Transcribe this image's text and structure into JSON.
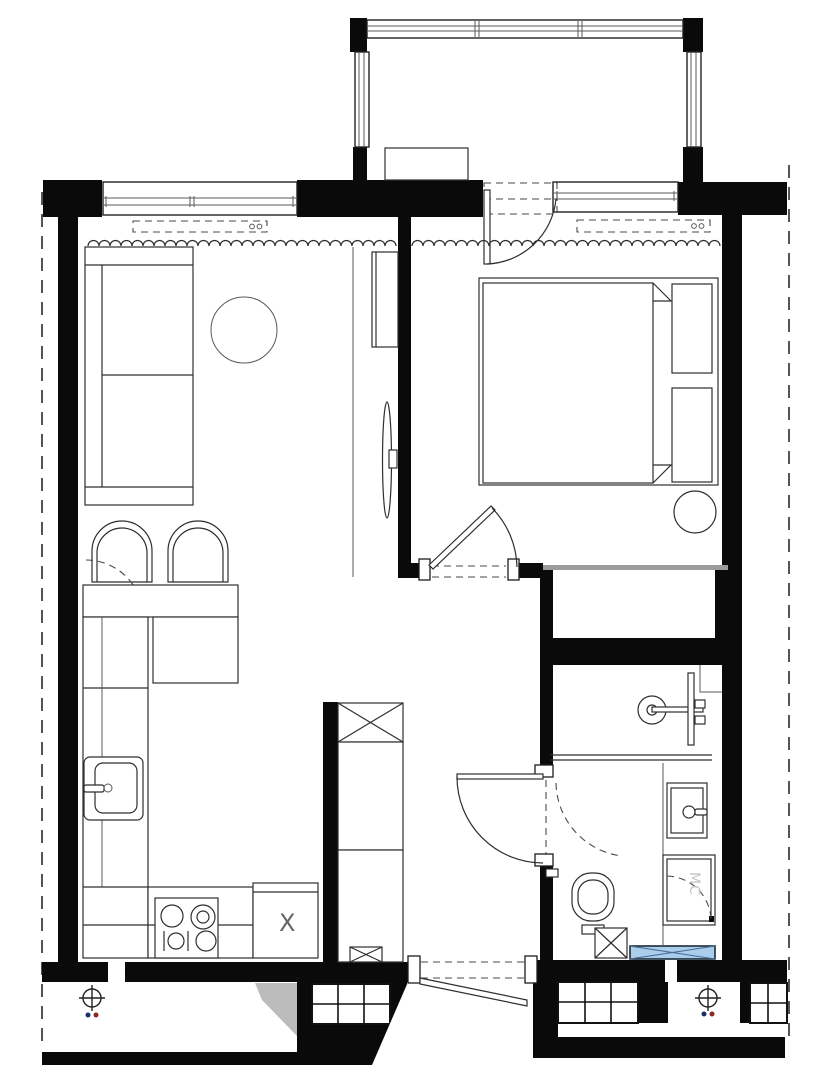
{
  "floorplan": {
    "type": "apartment-floor-plan",
    "labels": {
      "kitchen_cabinet_mark": "X",
      "washing_machine_mark": "MC"
    },
    "colors": {
      "wall": "#0a0a0a",
      "line": "#2e2e2e",
      "washer_fill": "#a9cdeb",
      "washer_border": "#1c2b3a",
      "washer_cross": "#4a6d96",
      "marker_dot_blue": "#1c2f6b",
      "marker_dot_red": "#8a2a22",
      "shade_gray": "#bcbcbc",
      "light_wall_gray": "#9b9b9b"
    },
    "rooms": [
      "balcony",
      "living-room",
      "bedroom",
      "kitchen",
      "hallway",
      "bathroom",
      "closet-niche",
      "lower-terrace"
    ],
    "fixtures": [
      "sofa",
      "coffee-table",
      "tv-console",
      "tv",
      "dining-chairs",
      "dining-table",
      "kitchen-counter",
      "kitchen-sink",
      "stove",
      "extract-cabinet",
      "vent-shaft",
      "wardrobe-cabinet",
      "double-bed",
      "pillows",
      "bedside-pouf",
      "curtain-pelmets",
      "curtains",
      "shower",
      "washbasin",
      "washing-machine",
      "toilet",
      "floor-drain",
      "radiator-mat",
      "survey-markers",
      "window-grids",
      "boundary-dashed-lines"
    ]
  }
}
